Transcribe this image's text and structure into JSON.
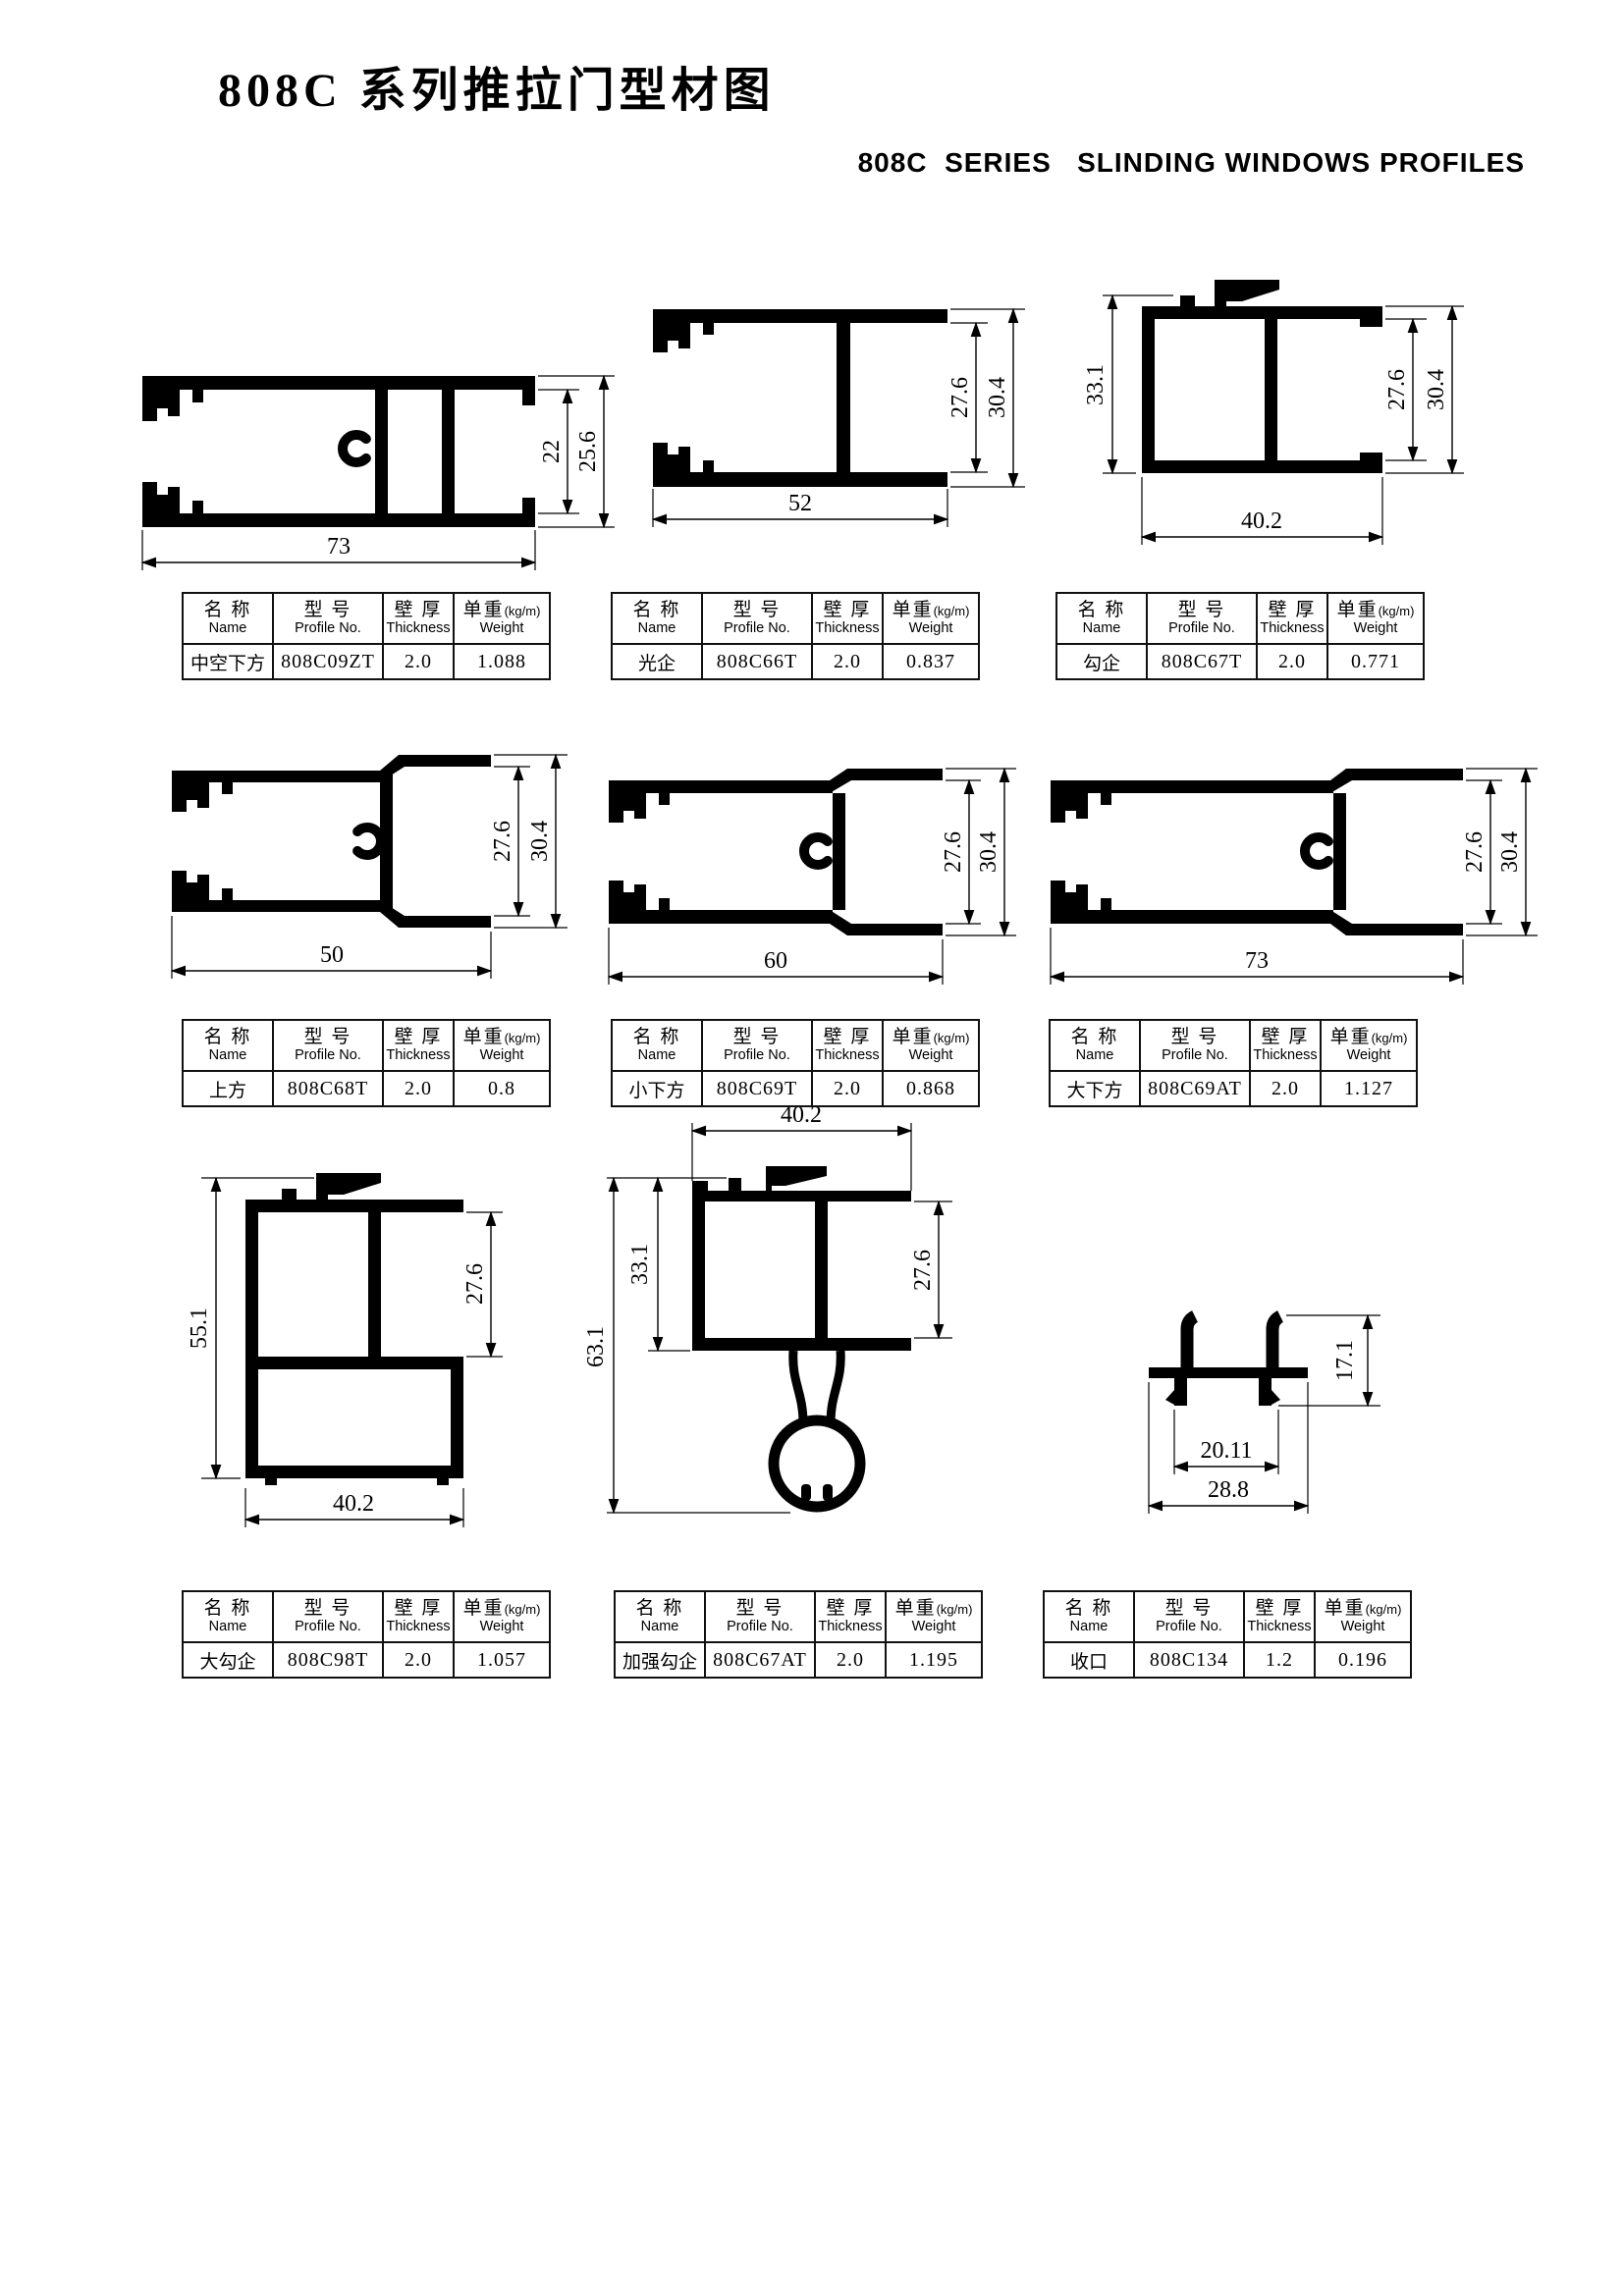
{
  "page": {
    "title": "808C 系列推拉门型材图",
    "subtitle": "808C  SERIES   SLINDING WINDOWS PROFILES"
  },
  "table_header": {
    "name_cn": "名 称",
    "name_en": "Name",
    "model_cn": "型 号",
    "model_en": "Profile No.",
    "thickness_cn": "壁 厚",
    "thickness_en": "Thickness",
    "weight_cn": "单重",
    "weight_paren": "(kg/m)",
    "weight_en": "Weight"
  },
  "profiles": [
    {
      "name": "中空下方",
      "model": "808C09ZT",
      "thickness": "2.0",
      "weight": "1.088",
      "dims": {
        "bottom": "73",
        "inner": "22",
        "outer": "25.6"
      }
    },
    {
      "name": "光企",
      "model": "808C66T",
      "thickness": "2.0",
      "weight": "0.837",
      "dims": {
        "bottom": "52",
        "inner": "27.6",
        "outer": "30.4"
      }
    },
    {
      "name": "勾企",
      "model": "808C67T",
      "thickness": "2.0",
      "weight": "0.771",
      "dims": {
        "bottom": "40.2",
        "inner": "27.6",
        "outer": "30.4",
        "left": "33.1"
      }
    },
    {
      "name": "上方",
      "model": "808C68T",
      "thickness": "2.0",
      "weight": "0.8",
      "dims": {
        "bottom": "50",
        "inner": "27.6",
        "outer": "30.4"
      }
    },
    {
      "name": "小下方",
      "model": "808C69T",
      "thickness": "2.0",
      "weight": "0.868",
      "dims": {
        "bottom": "60",
        "inner": "27.6",
        "outer": "30.4"
      }
    },
    {
      "name": "大下方",
      "model": "808C69AT",
      "thickness": "2.0",
      "weight": "1.127",
      "dims": {
        "bottom": "73",
        "inner": "27.6",
        "outer": "30.4"
      }
    },
    {
      "name": "大勾企",
      "model": "808C98T",
      "thickness": "2.0",
      "weight": "1.057",
      "dims": {
        "bottom": "40.2",
        "inner": "27.6",
        "left": "55.1"
      }
    },
    {
      "name": "加强勾企",
      "model": "808C67AT",
      "thickness": "2.0",
      "weight": "1.195",
      "dims": {
        "top": "40.2",
        "inner": "27.6",
        "left_outer": "63.1",
        "left_inner": "33.1"
      }
    },
    {
      "name": "收口",
      "model": "808C134",
      "thickness": "1.2",
      "weight": "0.196",
      "dims": {
        "inner": "20.11",
        "outer": "28.8",
        "right": "17.1"
      }
    }
  ]
}
